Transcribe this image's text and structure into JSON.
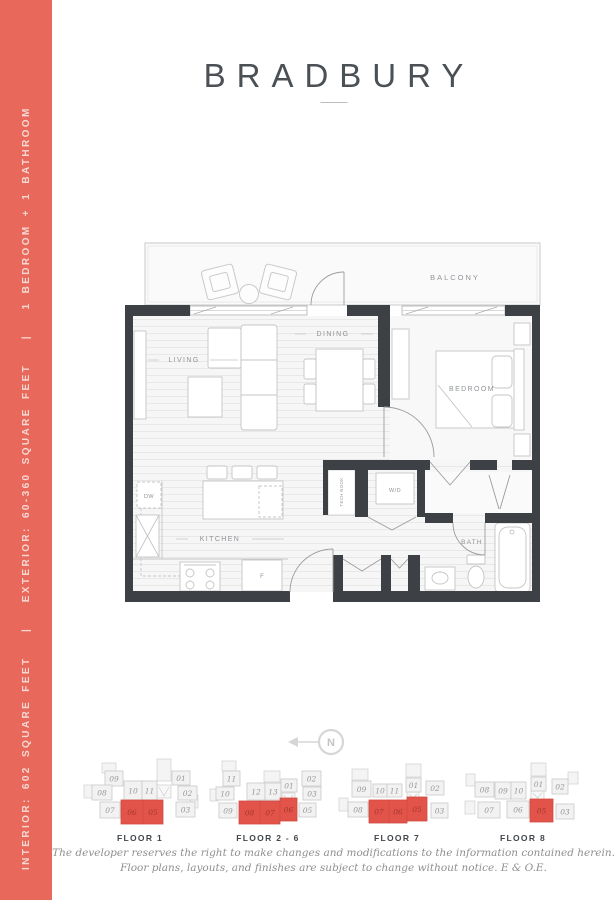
{
  "sidebar": {
    "segments": [
      "INTERIOR: 602 SQUARE FEET",
      "EXTERIOR: 60-360 SQUARE FEET",
      "1 BEDROOM + 1 BATHROOM"
    ],
    "bg_color": "#e8695c",
    "text_color": "#f6d8d2"
  },
  "header": {
    "title": "BRADBURY"
  },
  "plan": {
    "labels": {
      "balcony": "BALCONY",
      "living": "LIVING",
      "dining": "DINING",
      "bedroom": "BEDROOM",
      "kitchen": "KITCHEN",
      "bath": "BATH",
      "wd": "W/D",
      "dw": "DW",
      "fridge": "F",
      "tech_nook": "TECH NOOK"
    },
    "wall_color": "#3d4145"
  },
  "compass": {
    "label": "N"
  },
  "keyplans": {
    "highlight_color": "#e2544a",
    "highlight_text_color": "#a6362d",
    "floors": [
      {
        "label": "FLOOR 1",
        "blanks": [
          [
            77,
            2,
            14,
            22
          ],
          [
            22,
            6,
            14,
            10
          ],
          [
            4,
            28,
            10,
            13
          ],
          [
            110,
            38,
            8,
            13
          ]
        ],
        "core": [
          77,
          28,
          14,
          13
        ],
        "units": [
          {
            "n": "09",
            "x": 25,
            "y": 14,
            "w": 18,
            "h": 15,
            "hl": false
          },
          {
            "n": "08",
            "x": 12,
            "y": 28,
            "w": 20,
            "h": 15,
            "hl": false
          },
          {
            "n": "10",
            "x": 44,
            "y": 24,
            "w": 18,
            "h": 19,
            "hl": false
          },
          {
            "n": "11",
            "x": 62,
            "y": 24,
            "w": 15,
            "h": 19,
            "hl": false
          },
          {
            "n": "01",
            "x": 92,
            "y": 14,
            "w": 18,
            "h": 14,
            "hl": false
          },
          {
            "n": "02",
            "x": 98,
            "y": 29,
            "w": 19,
            "h": 14,
            "hl": false
          },
          {
            "n": "07",
            "x": 20,
            "y": 45,
            "w": 20,
            "h": 16,
            "hl": false
          },
          {
            "n": "06",
            "x": 41,
            "y": 43,
            "w": 22,
            "h": 24,
            "hl": true
          },
          {
            "n": "05",
            "x": 63,
            "y": 43,
            "w": 20,
            "h": 24,
            "hl": true
          },
          {
            "n": "03",
            "x": 96,
            "y": 45,
            "w": 19,
            "h": 15,
            "hl": false
          }
        ]
      },
      {
        "label": "FLOOR 2 - 6",
        "blanks": [
          [
            56,
            14,
            16,
            11
          ],
          [
            2,
            32,
            8,
            12
          ],
          [
            14,
            4,
            14,
            10
          ]
        ],
        "core": [
          74,
          36,
          13,
          10
        ],
        "units": [
          {
            "n": "11",
            "x": 15,
            "y": 14,
            "w": 17,
            "h": 15,
            "hl": false
          },
          {
            "n": "10",
            "x": 8,
            "y": 30,
            "w": 18,
            "h": 13,
            "hl": false
          },
          {
            "n": "12",
            "x": 39,
            "y": 26,
            "w": 18,
            "h": 17,
            "hl": false
          },
          {
            "n": "13",
            "x": 57,
            "y": 26,
            "w": 16,
            "h": 17,
            "hl": false
          },
          {
            "n": "01",
            "x": 73,
            "y": 22,
            "w": 16,
            "h": 13,
            "hl": false
          },
          {
            "n": "02",
            "x": 94,
            "y": 14,
            "w": 19,
            "h": 15,
            "hl": false
          },
          {
            "n": "03",
            "x": 95,
            "y": 30,
            "w": 18,
            "h": 13,
            "hl": false
          },
          {
            "n": "09",
            "x": 11,
            "y": 46,
            "w": 18,
            "h": 15,
            "hl": false
          },
          {
            "n": "08",
            "x": 31,
            "y": 44,
            "w": 21,
            "h": 23,
            "hl": true
          },
          {
            "n": "07",
            "x": 52,
            "y": 44,
            "w": 20,
            "h": 23,
            "hl": true
          },
          {
            "n": "06",
            "x": 72,
            "y": 41,
            "w": 17,
            "h": 23,
            "hl": true
          },
          {
            "n": "05",
            "x": 91,
            "y": 46,
            "w": 17,
            "h": 14,
            "hl": false
          }
        ]
      },
      {
        "label": "FLOOR 7",
        "blanks": [
          [
            69,
            7,
            15,
            13
          ],
          [
            15,
            12,
            16,
            11
          ],
          [
            2,
            41,
            9,
            13
          ]
        ],
        "core": [
          70,
          35,
          12,
          8
        ],
        "units": [
          {
            "n": "09",
            "x": 15,
            "y": 24,
            "w": 19,
            "h": 16,
            "hl": false
          },
          {
            "n": "10",
            "x": 36,
            "y": 27,
            "w": 14,
            "h": 13,
            "hl": false
          },
          {
            "n": "11",
            "x": 50,
            "y": 27,
            "w": 15,
            "h": 13,
            "hl": false
          },
          {
            "n": "01",
            "x": 69,
            "y": 21,
            "w": 15,
            "h": 14,
            "hl": false
          },
          {
            "n": "02",
            "x": 89,
            "y": 24,
            "w": 18,
            "h": 14,
            "hl": false
          },
          {
            "n": "08",
            "x": 11,
            "y": 45,
            "w": 20,
            "h": 15,
            "hl": false
          },
          {
            "n": "07",
            "x": 32,
            "y": 43,
            "w": 20,
            "h": 23,
            "hl": true
          },
          {
            "n": "06",
            "x": 52,
            "y": 43,
            "w": 18,
            "h": 23,
            "hl": true
          },
          {
            "n": "05",
            "x": 70,
            "y": 40,
            "w": 20,
            "h": 24,
            "hl": true
          },
          {
            "n": "03",
            "x": 94,
            "y": 46,
            "w": 17,
            "h": 15,
            "hl": false
          }
        ]
      },
      {
        "label": "FLOOR 8",
        "blanks": [
          [
            68,
            6,
            15,
            13
          ],
          [
            3,
            17,
            9,
            12
          ],
          [
            105,
            15,
            10,
            12
          ],
          [
            2,
            44,
            10,
            13
          ]
        ],
        "core": [
          68,
          34,
          13,
          9
        ],
        "units": [
          {
            "n": "08",
            "x": 12,
            "y": 25,
            "w": 19,
            "h": 15,
            "hl": false
          },
          {
            "n": "09",
            "x": 32,
            "y": 25,
            "w": 16,
            "h": 17,
            "hl": false
          },
          {
            "n": "10",
            "x": 48,
            "y": 25,
            "w": 15,
            "h": 17,
            "hl": false
          },
          {
            "n": "01",
            "x": 68,
            "y": 20,
            "w": 15,
            "h": 14,
            "hl": false
          },
          {
            "n": "02",
            "x": 89,
            "y": 22,
            "w": 16,
            "h": 15,
            "hl": false
          },
          {
            "n": "07",
            "x": 15,
            "y": 45,
            "w": 22,
            "h": 16,
            "hl": false
          },
          {
            "n": "06",
            "x": 44,
            "y": 44,
            "w": 22,
            "h": 17,
            "hl": false
          },
          {
            "n": "05",
            "x": 67,
            "y": 42,
            "w": 23,
            "h": 23,
            "hl": true
          },
          {
            "n": "03",
            "x": 93,
            "y": 47,
            "w": 18,
            "h": 15,
            "hl": false
          }
        ]
      }
    ]
  },
  "disclaimer": {
    "line1": "The developer reserves the right to make changes and modifications to the information contained herein.",
    "line2": "Floor plans, layouts, and finishes are subject to change without notice. E & O.E."
  }
}
